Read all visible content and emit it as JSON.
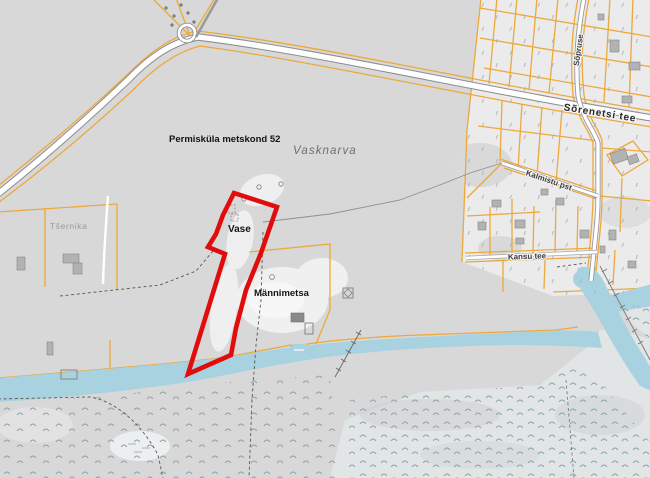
{
  "map": {
    "labels": {
      "forest_district": "Permisküla metskond 52",
      "village": "Vasknarva",
      "place_vase": "Vase",
      "place_mannimetsa": "Männimetsa",
      "place_tsernika": "Tšernika",
      "road_sorenetsi": "Sõrenetsi tee",
      "road_sopruse": "Sõpruse",
      "road_kalmistu": "Kalmistu pst",
      "road_kansu": "Kansu tee"
    },
    "colors": {
      "land": "#d8d8d8",
      "village_land": "#ebebeb",
      "marsh_land": "#e1e5e6",
      "clearing": "#f0f0f0",
      "water": "#a9d2e0",
      "cadastral_line": "#eda83c",
      "road_fill": "#ffffff",
      "road_casing": "#8f8f8f",
      "highlight_parcel": "#e10c0c",
      "building": "#b2b2b2"
    },
    "highlight_parcel": {
      "points": "234,193 277,207 261,253 246,290 236,328 231,355 188,374 225,254 208,247 216,234 223,215"
    }
  }
}
